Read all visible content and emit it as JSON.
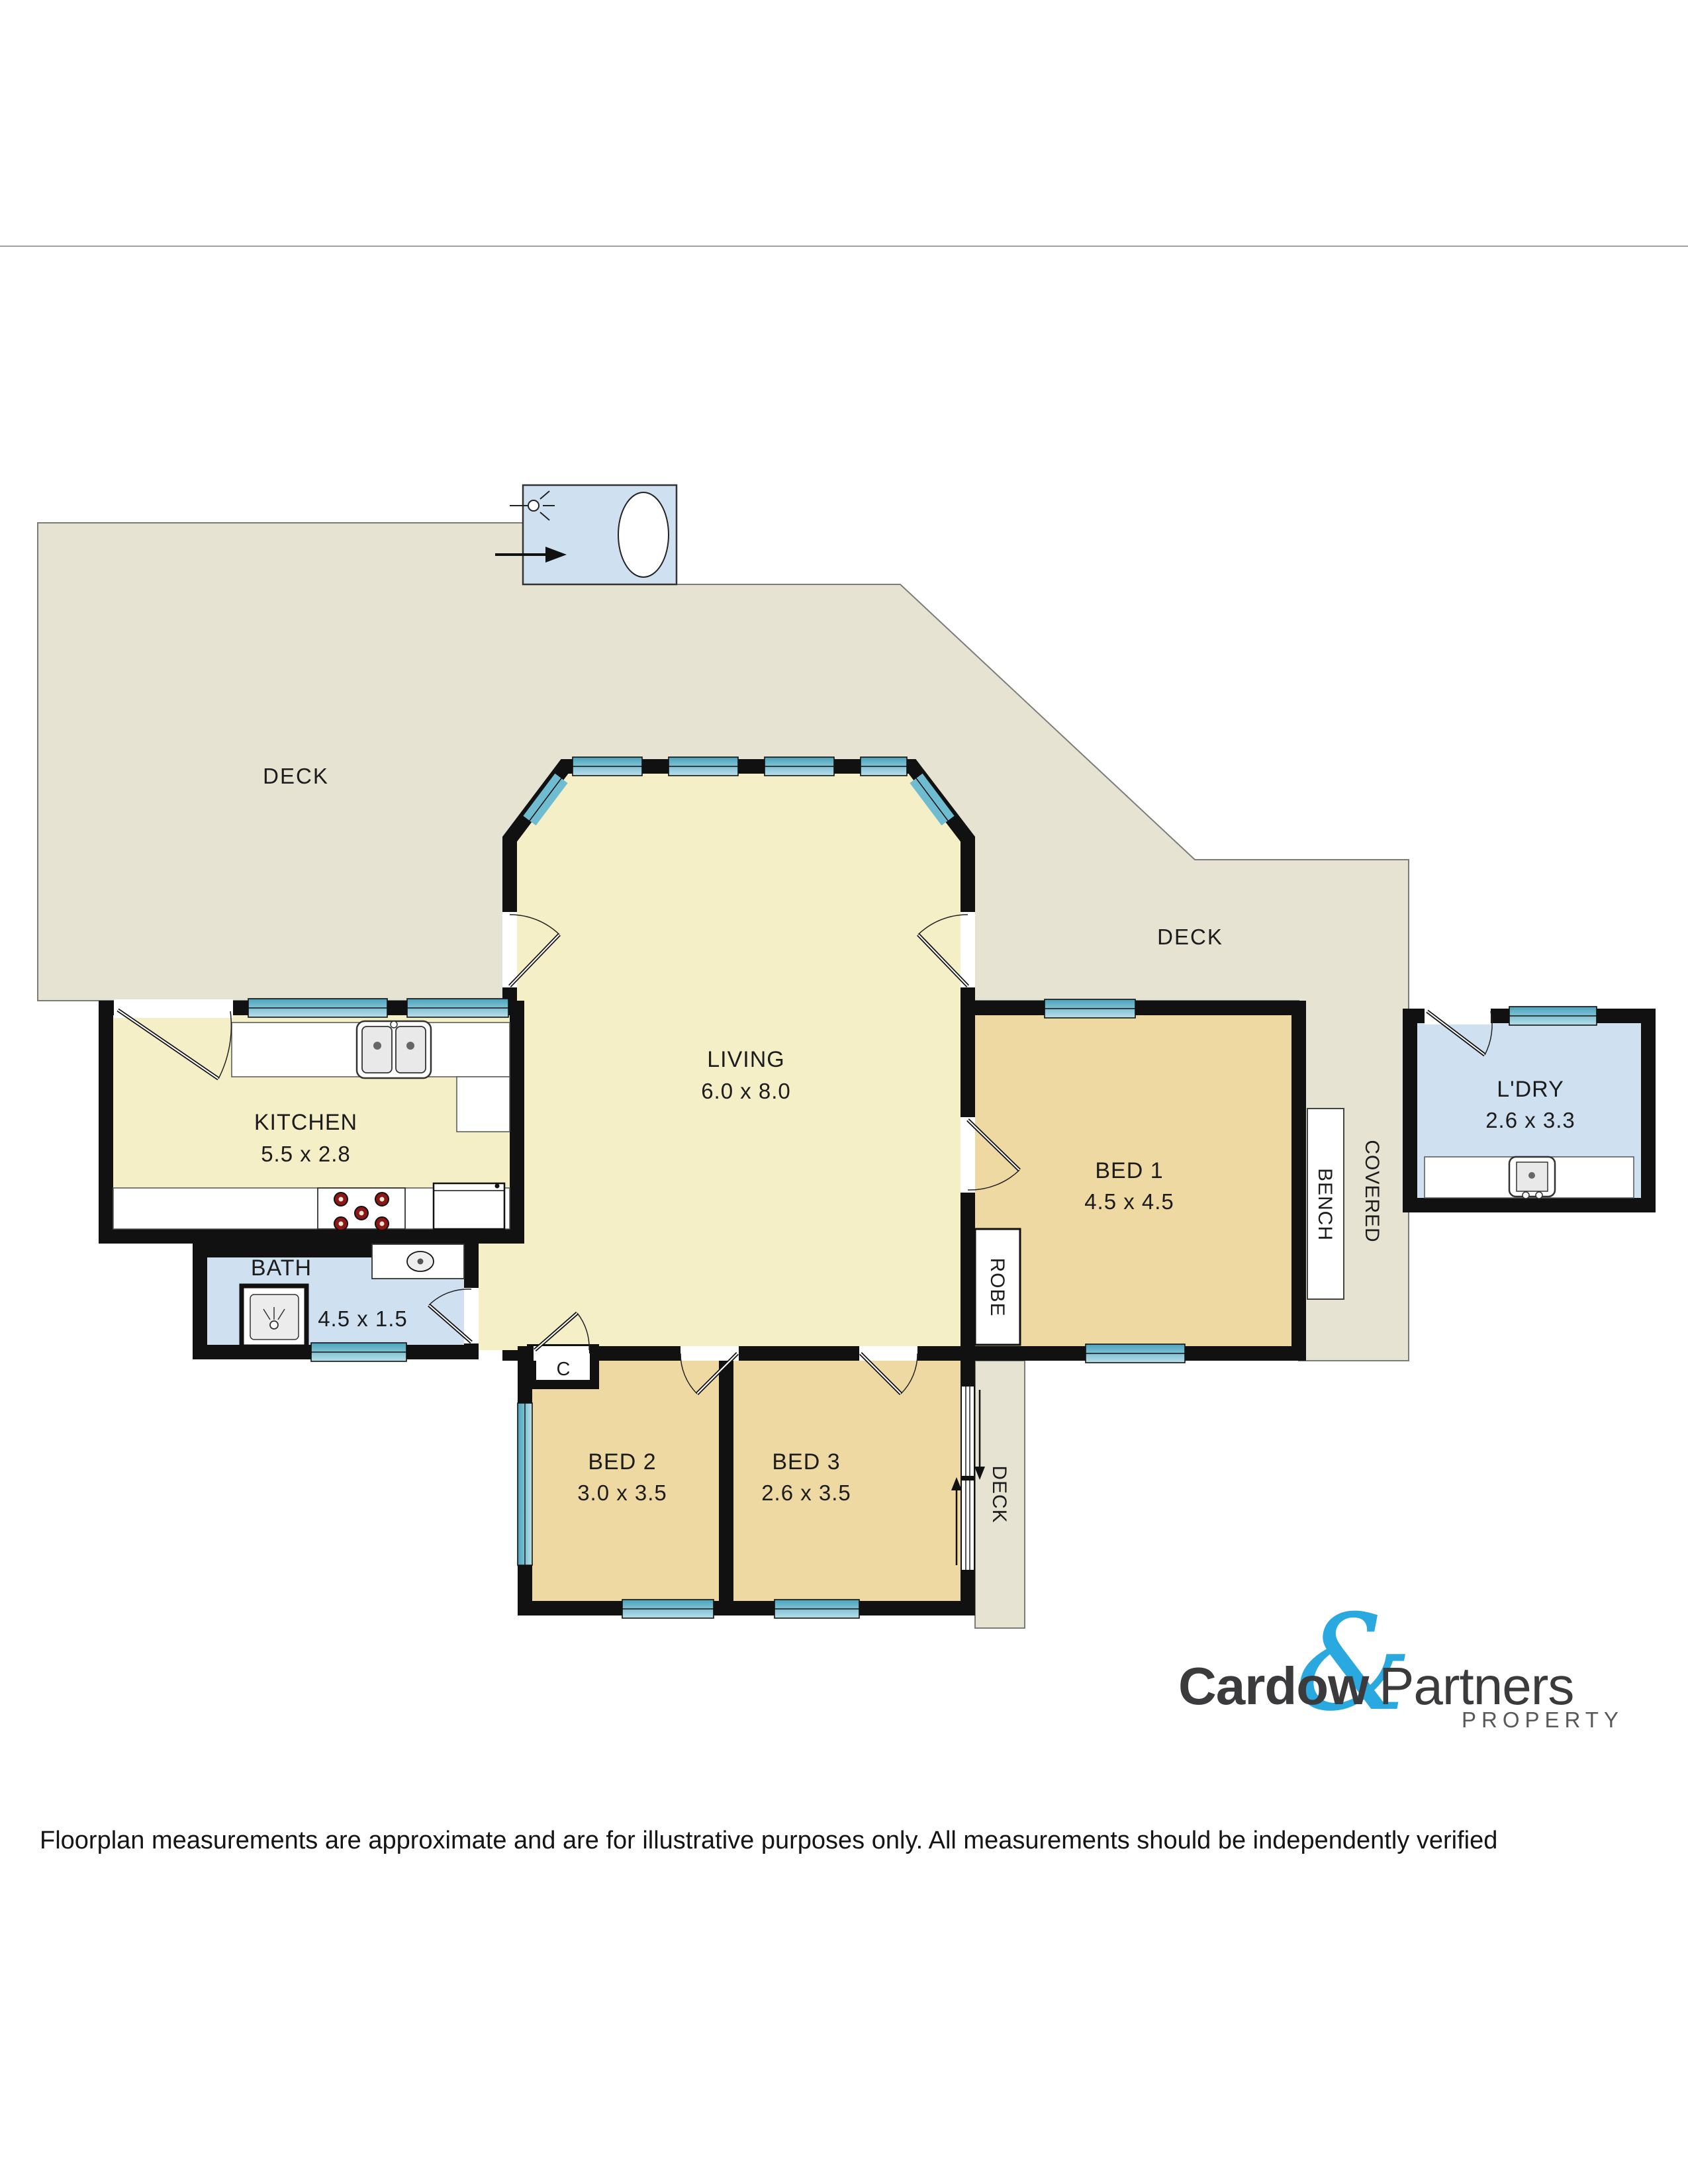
{
  "plan": {
    "labels": {
      "deck_left": "DECK",
      "deck_right": "DECK",
      "deck_side": "DECK",
      "covered": "COVERED",
      "bench": "BENCH",
      "robe": "ROBE",
      "closet": "C"
    },
    "rooms": {
      "living": {
        "name": "LIVING",
        "dims": "6.0 x 8.0"
      },
      "kitchen": {
        "name": "KITCHEN",
        "dims": "5.5 x 2.8"
      },
      "bath": {
        "name": "BATH",
        "dims": "4.5 x 1.5"
      },
      "bed1": {
        "name": "BED 1",
        "dims": "4.5 x 4.5"
      },
      "bed2": {
        "name": "BED 2",
        "dims": "3.0 x 3.5"
      },
      "bed3": {
        "name": "BED 3",
        "dims": "2.6 x 3.5"
      },
      "laundry": {
        "name": "L'DRY",
        "dims": "2.6 x 3.3"
      }
    },
    "colors": {
      "deck": "#e6e3d2",
      "living_yellow": "#f5efc8",
      "bedroom_tan": "#edd9a1",
      "wet_area_blue": "#cfe0f0",
      "window_teal": "#49a3bc",
      "wall_black": "#111111"
    }
  },
  "logo": {
    "word_left": "Cardow",
    "ampersand": "&",
    "word_right": "Partners",
    "tagline": "PROPERTY",
    "accent_color": "#2aa9e0",
    "text_color": "#3b3b3d"
  },
  "footer": {
    "disclaimer": "Floorplan measurements are approximate and are for illustrative purposes only. All measurements should be independently verified"
  }
}
